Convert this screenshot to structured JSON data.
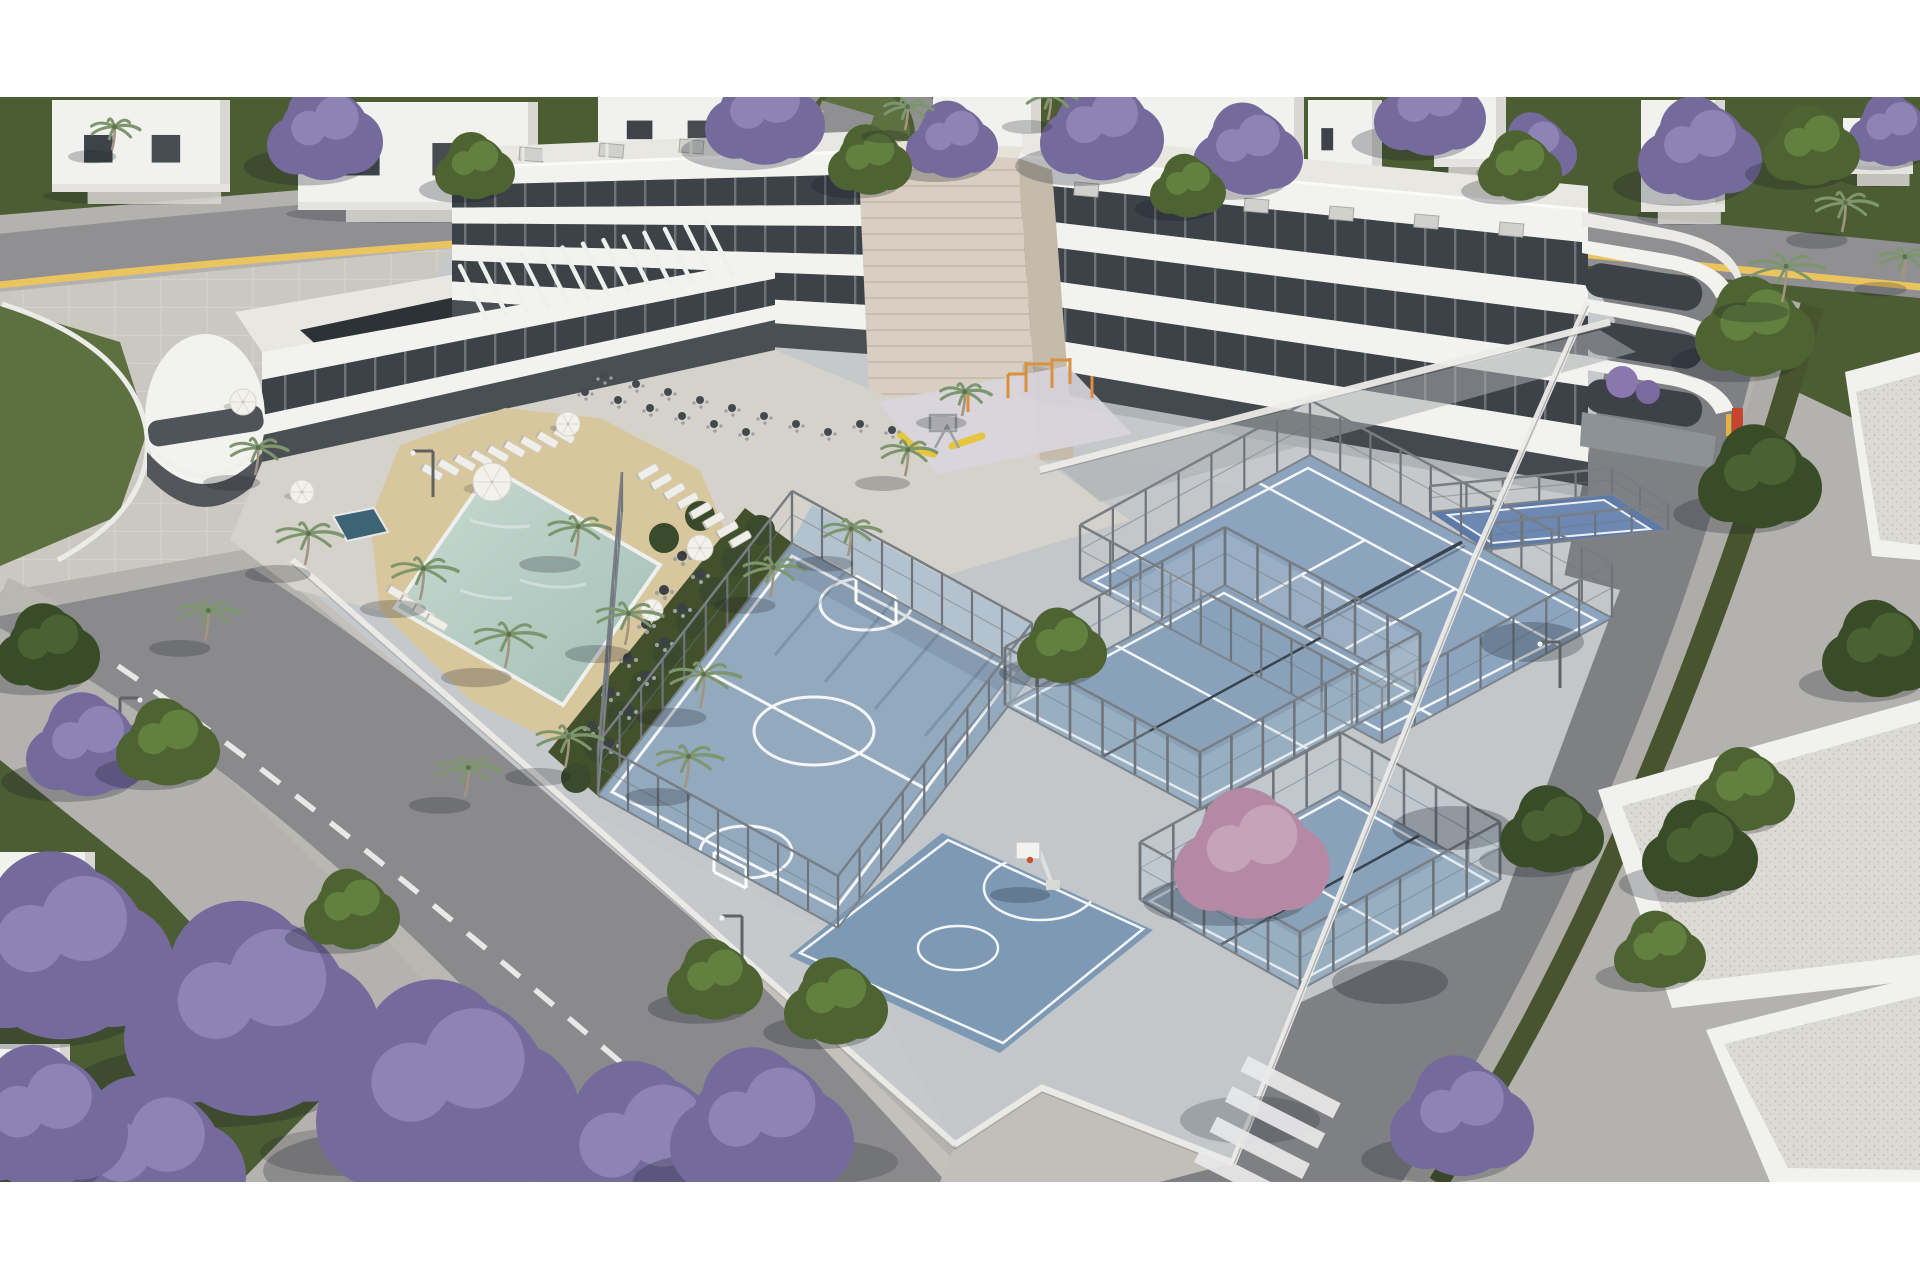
{
  "canvas": {
    "width": 1920,
    "height": 1280,
    "frame_top": 97,
    "frame_bottom": 1182
  },
  "colors": {
    "letterbox": "#ffffff",
    "base": "#b4b2ae",
    "grass": "#4c5c33",
    "grass_light": "#5d7040",
    "plaza": "#cbc8c1",
    "road": "#8a8a8d",
    "road_dark": "#7f8084",
    "sidewalk": "#b9b7b2",
    "sidewalk_warm": "#c4c1bc",
    "verge": "#47542e",
    "yellow_line": "#eac45f",
    "lane_white": "#f2f2f2",
    "property": "#c6c9cb",
    "sports_base": "#c3c7ca",
    "amenity": "#d5d2cb",
    "sand": "#d8c69c",
    "pool": "#b9cfc7",
    "pool_deep": "#9fbcb4",
    "spa": "#3c6474",
    "garden": "#42502c",
    "hedge": "#3a4a2c",
    "playground": "#d9d5de",
    "futsal": "#92a9be",
    "futsal_apron": "#b3c2cf",
    "basket": "#7e99b4",
    "tennis": "#8ca4bd",
    "tennis_in": "#7f99b5",
    "padel": "#8aa2b9",
    "padel_blue": "#5d7aa8",
    "padel_blue_in": "#6d88b2",
    "court_line": "#f4f6f8",
    "net_dark": "#39434d",
    "building": "#f2f2ef",
    "roof": "#e8e7e2",
    "window": "#3c4248",
    "colonnade": "#4a4f54",
    "stone": "#d8cfc2",
    "stone_side": "#c5bbaa",
    "stone_top": "#e7e2d8",
    "solar": "#2d3237",
    "fence_metal": "#6e747a",
    "fence_white": "#ecebe7",
    "glass": "rgba(190,205,215,0.28)",
    "umbrella": "#f2f1ec",
    "lounger": "#efeee9",
    "orange": "#d9913f",
    "slide": "#e6c53e",
    "sign_red": "#c6452c",
    "sign_yellow": "#e5b33c",
    "gravel": "#dcdad5",
    "white_house": "#f1f1ee",
    "jacaranda": "#756a9c",
    "jacaranda_light": "#8d83b4",
    "tree_green": "#4d6432",
    "tree_green_light": "#62803f",
    "tree_dark": "#394c28",
    "tree_dark_light": "#4a6132",
    "pink_tree": "#b389a3",
    "pink_tree_light": "#c7a3b9",
    "palm": "#7e966d",
    "palm_trunk": "#a3947f"
  },
  "scene": {
    "houses": [
      [
        52,
        100,
        178,
        92
      ],
      [
        298,
        102,
        240,
        108
      ],
      [
        598,
        97,
        160,
        62
      ],
      [
        933,
        97,
        108,
        80
      ],
      [
        1072,
        97,
        232,
        132
      ],
      [
        1308,
        100,
        74,
        74
      ],
      [
        1434,
        97,
        72,
        70
      ],
      [
        1641,
        100,
        84,
        112
      ],
      [
        1843,
        118,
        70,
        56
      ],
      [
        0,
        852,
        95,
        86
      ],
      [
        0,
        1044,
        70,
        90
      ]
    ],
    "facades": [
      {
        "x0": 452,
        "y0": 168,
        "b0": 300,
        "x1": 868,
        "y1": 151,
        "b1": 330,
        "bands": [
          [
            "w",
            0,
            0.13
          ],
          [
            "d",
            0.13,
            0.3
          ],
          [
            "w",
            0.3,
            0.42
          ],
          [
            "d",
            0.42,
            0.58
          ],
          [
            "w",
            0.58,
            0.7
          ],
          [
            "d",
            0.7,
            0.86
          ],
          [
            "w",
            0.86,
            1
          ]
        ],
        "ground": true
      },
      {
        "x0": 1022,
        "y0": 156,
        "b0": 364,
        "x1": 1588,
        "y1": 210,
        "b1": 462,
        "bands": [
          [
            "w",
            0,
            0.13
          ],
          [
            "d",
            0.13,
            0.3
          ],
          [
            "w",
            0.3,
            0.42
          ],
          [
            "d",
            0.42,
            0.58
          ],
          [
            "w",
            0.58,
            0.7
          ],
          [
            "d",
            0.7,
            0.86
          ],
          [
            "w",
            0.86,
            1
          ]
        ],
        "ground": true
      },
      {
        "x0": 262,
        "y0": 352,
        "b0": 478,
        "x1": 775,
        "y1": 258,
        "b1": 352,
        "bands": [
          [
            "w",
            0,
            0.22
          ],
          [
            "d",
            0.22,
            0.5
          ],
          [
            "w",
            0.5,
            0.66
          ],
          [
            "g",
            0.66,
            1
          ]
        ],
        "ground": false
      }
    ],
    "fences": [
      {
        "pts": [
          [
            598,
            795
          ],
          [
            792,
            543
          ],
          [
            1032,
            675
          ],
          [
            838,
            928
          ],
          [
            598,
            795
          ]
        ],
        "h": 52,
        "type": "wire"
      },
      {
        "pts": [
          [
            1080,
            580
          ],
          [
            1310,
            455
          ],
          [
            1612,
            618
          ],
          [
            1382,
            743
          ],
          [
            1080,
            580
          ]
        ],
        "h": 55,
        "type": "wire"
      },
      {
        "pts": [
          [
            1005,
            705
          ],
          [
            1225,
            585
          ],
          [
            1420,
            690
          ],
          [
            1200,
            810
          ],
          [
            1005,
            705
          ]
        ],
        "h": 58,
        "type": "glass"
      },
      {
        "pts": [
          [
            1140,
            900
          ],
          [
            1340,
            790
          ],
          [
            1500,
            880
          ],
          [
            1300,
            990
          ],
          [
            1140,
            900
          ]
        ],
        "h": 58,
        "type": "glass"
      },
      {
        "pts": [
          [
            1430,
            512
          ],
          [
            1612,
            494
          ],
          [
            1668,
            530
          ],
          [
            1486,
            550
          ]
        ],
        "h": 26,
        "type": "wire"
      },
      {
        "pts": [
          [
            622,
            512
          ],
          [
            598,
            795
          ]
        ],
        "h": 40,
        "type": "wire"
      },
      {
        "pts": [
          [
            292,
            560
          ],
          [
            955,
            1145
          ]
        ],
        "type": "picket"
      },
      {
        "pts": [
          [
            955,
            1145
          ],
          [
            1042,
            1088
          ],
          [
            1233,
            1163
          ]
        ],
        "type": "picket"
      },
      {
        "pts": [
          [
            1233,
            1163
          ],
          [
            1474,
            560
          ],
          [
            1588,
            302
          ]
        ],
        "type": "picket"
      },
      {
        "pts": [
          [
            1040,
            470
          ],
          [
            1300,
            402
          ],
          [
            1610,
            322
          ]
        ],
        "type": "picket"
      }
    ],
    "lounger_rows": [
      {
        "x": 432,
        "y": 472,
        "dx": 16.5,
        "dy": -4.6,
        "n": 9,
        "a": 30
      },
      {
        "x": 648,
        "y": 472,
        "dx": 13.2,
        "dy": 9.6,
        "n": 8,
        "a": -30
      },
      {
        "x": 398,
        "y": 594,
        "dx": 13,
        "dy": 9.5,
        "n": 4,
        "a": 30
      }
    ],
    "umbrellas": [
      [
        492,
        482,
        19
      ],
      [
        243,
        402,
        13
      ],
      [
        568,
        424,
        12
      ],
      [
        700,
        548,
        13
      ],
      [
        652,
        610,
        11
      ],
      [
        302,
        492,
        12
      ]
    ],
    "garden_tables": [
      [
        682,
        556
      ],
      [
        664,
        590
      ],
      [
        646,
        624
      ],
      [
        628,
        658
      ],
      [
        610,
        692
      ],
      [
        592,
        726
      ],
      [
        700,
        574
      ],
      [
        682,
        608
      ],
      [
        664,
        642
      ],
      [
        646,
        676
      ],
      [
        628,
        710
      ],
      [
        610,
        744
      ]
    ],
    "terrace_tables": [
      [
        585,
        392
      ],
      [
        618,
        400
      ],
      [
        650,
        408
      ],
      [
        682,
        416
      ],
      [
        714,
        424
      ],
      [
        746,
        432
      ],
      [
        604,
        376
      ],
      [
        636,
        384
      ],
      [
        668,
        392
      ],
      [
        700,
        400
      ],
      [
        732,
        408
      ],
      [
        764,
        416
      ],
      [
        796,
        424
      ],
      [
        828,
        432
      ],
      [
        860,
        424
      ],
      [
        892,
        430
      ]
    ],
    "hedges": [
      [
        760,
        530
      ],
      [
        737,
        561
      ],
      [
        714,
        592
      ],
      [
        691,
        623
      ],
      [
        668,
        654
      ],
      [
        645,
        685
      ],
      [
        622,
        716
      ],
      [
        599,
        747
      ],
      [
        576,
        778
      ],
      [
        700,
        516
      ],
      [
        664,
        538
      ]
    ],
    "calisthenics": {
      "v": [
        [
          1008,
          398,
          24
        ],
        [
          1026,
          392,
          30
        ],
        [
          1052,
          388,
          30
        ],
        [
          1070,
          384,
          26
        ],
        [
          1092,
          398,
          22
        ],
        [
          968,
          412,
          20
        ]
      ],
      "h": [
        [
          1026,
          392,
          1052,
          392
        ],
        [
          1008,
          402,
          1026,
          402
        ],
        [
          1052,
          388,
          1070,
          388
        ]
      ]
    },
    "slats": [
      {
        "x": 486,
        "y": 318,
        "dx": 20.5,
        "dy": -3.7,
        "n": 13,
        "ex": -26,
        "ey": -52,
        "w": 4.5,
        "c": "#eef0ec"
      },
      {
        "x": 460,
        "y": 163,
        "dx": 21,
        "dy": -0.85,
        "n": 20,
        "ex": 0,
        "ey": -12,
        "w": 3,
        "c": "#e8e8e4"
      }
    ],
    "ac_units": [
      [
        520,
        147
      ],
      [
        600,
        143
      ],
      [
        680,
        139
      ],
      [
        758,
        136
      ],
      [
        1075,
        182
      ],
      [
        1160,
        190
      ],
      [
        1245,
        198
      ],
      [
        1330,
        206
      ],
      [
        1415,
        214
      ],
      [
        1500,
        222
      ]
    ],
    "street_lights": [
      [
        433,
        497,
        -1
      ],
      [
        120,
        744,
        1
      ],
      [
        742,
        962,
        -1
      ],
      [
        1560,
        688,
        -1
      ]
    ],
    "shadow_blobs": [
      [
        1452,
        828,
        60,
        22,
        0.28
      ],
      [
        1532,
        642,
        52,
        20,
        0.26
      ],
      [
        1390,
        982,
        58,
        22,
        0.28
      ],
      [
        1250,
        1120,
        70,
        24,
        0.22
      ],
      [
        348,
        1152,
        88,
        24,
        0.2
      ],
      [
        820,
        1162,
        78,
        22,
        0.2
      ]
    ],
    "grass_patches": [
      [
        1250,
        300,
        160,
        46
      ],
      [
        1600,
        380,
        140,
        40
      ],
      [
        900,
        250,
        120,
        36
      ],
      [
        400,
        200,
        100,
        30
      ]
    ],
    "crosswalk": {
      "x": 1248,
      "y": 1056,
      "angle": 27,
      "n": 4,
      "len": 104,
      "w": 17,
      "gap": 34
    },
    "trees": [
      {
        "t": "j",
        "x": 325,
        "y": 135,
        "r": 58
      },
      {
        "t": "j",
        "x": 765,
        "y": 118,
        "r": 60
      },
      {
        "t": "j",
        "x": 952,
        "y": 142,
        "r": 46
      },
      {
        "t": "j",
        "x": 1102,
        "y": 132,
        "r": 62
      },
      {
        "t": "j",
        "x": 1248,
        "y": 152,
        "r": 55
      },
      {
        "t": "j",
        "x": 1430,
        "y": 112,
        "r": 56
      },
      {
        "t": "j",
        "x": 1535,
        "y": 150,
        "r": 42
      },
      {
        "t": "j",
        "x": 1700,
        "y": 152,
        "r": 62
      },
      {
        "t": "j",
        "x": 1892,
        "y": 132,
        "r": 44
      },
      {
        "t": "j",
        "x": 62,
        "y": 952,
        "r": 112
      },
      {
        "t": "j",
        "x": 252,
        "y": 1016,
        "r": 128
      },
      {
        "t": "j",
        "x": 448,
        "y": 1098,
        "r": 132
      },
      {
        "t": "j",
        "x": 642,
        "y": 1158,
        "r": 108
      },
      {
        "t": "j",
        "x": 148,
        "y": 1164,
        "r": 98
      },
      {
        "t": "j",
        "x": 42,
        "y": 1122,
        "r": 86
      },
      {
        "t": "j",
        "x": 88,
        "y": 748,
        "r": 62
      },
      {
        "t": "j",
        "x": 1462,
        "y": 1120,
        "r": 72
      },
      {
        "t": "j",
        "x": 762,
        "y": 1130,
        "r": 92
      },
      {
        "t": "g",
        "x": 475,
        "y": 168,
        "r": 40
      },
      {
        "t": "g",
        "x": 870,
        "y": 162,
        "r": 42
      },
      {
        "t": "g",
        "x": 1188,
        "y": 188,
        "r": 38
      },
      {
        "t": "g",
        "x": 1520,
        "y": 168,
        "r": 42
      },
      {
        "t": "g",
        "x": 1812,
        "y": 148,
        "r": 48
      },
      {
        "t": "g",
        "x": 168,
        "y": 745,
        "r": 52
      },
      {
        "t": "g",
        "x": 715,
        "y": 982,
        "r": 48
      },
      {
        "t": "g",
        "x": 836,
        "y": 1004,
        "r": 52
      },
      {
        "t": "g",
        "x": 1062,
        "y": 648,
        "r": 45
      },
      {
        "t": "g",
        "x": 1660,
        "y": 952,
        "r": 46
      },
      {
        "t": "g",
        "x": 1745,
        "y": 792,
        "r": 50
      },
      {
        "t": "g",
        "x": 352,
        "y": 912,
        "r": 48
      },
      {
        "t": "g",
        "x": 1755,
        "y": 330,
        "r": 60
      },
      {
        "t": "d",
        "x": 1552,
        "y": 832,
        "r": 52
      },
      {
        "t": "d",
        "x": 1700,
        "y": 852,
        "r": 58
      },
      {
        "t": "d",
        "x": 1760,
        "y": 480,
        "r": 62
      },
      {
        "t": "d",
        "x": 1880,
        "y": 652,
        "r": 58
      },
      {
        "t": "d",
        "x": 48,
        "y": 650,
        "r": 52
      },
      {
        "t": "p",
        "x": 1252,
        "y": 858,
        "r": 78
      }
    ],
    "palms": [
      [
        255,
        475,
        26
      ],
      [
        305,
        565,
        30
      ],
      [
        205,
        640,
        28
      ],
      [
        420,
        600,
        30
      ],
      [
        505,
        668,
        32
      ],
      [
        575,
        556,
        28
      ],
      [
        625,
        645,
        30
      ],
      [
        700,
        708,
        32
      ],
      [
        770,
        597,
        28
      ],
      [
        565,
        768,
        30
      ],
      [
        465,
        797,
        28
      ],
      [
        685,
        788,
        30
      ],
      [
        848,
        556,
        26
      ],
      [
        905,
        476,
        25
      ],
      [
        962,
        416,
        23
      ],
      [
        1782,
        302,
        34
      ],
      [
        1842,
        232,
        28
      ],
      [
        1902,
        282,
        24
      ],
      [
        905,
        130,
        22
      ],
      [
        1048,
        120,
        23
      ],
      [
        112,
        150,
        22
      ]
    ]
  }
}
